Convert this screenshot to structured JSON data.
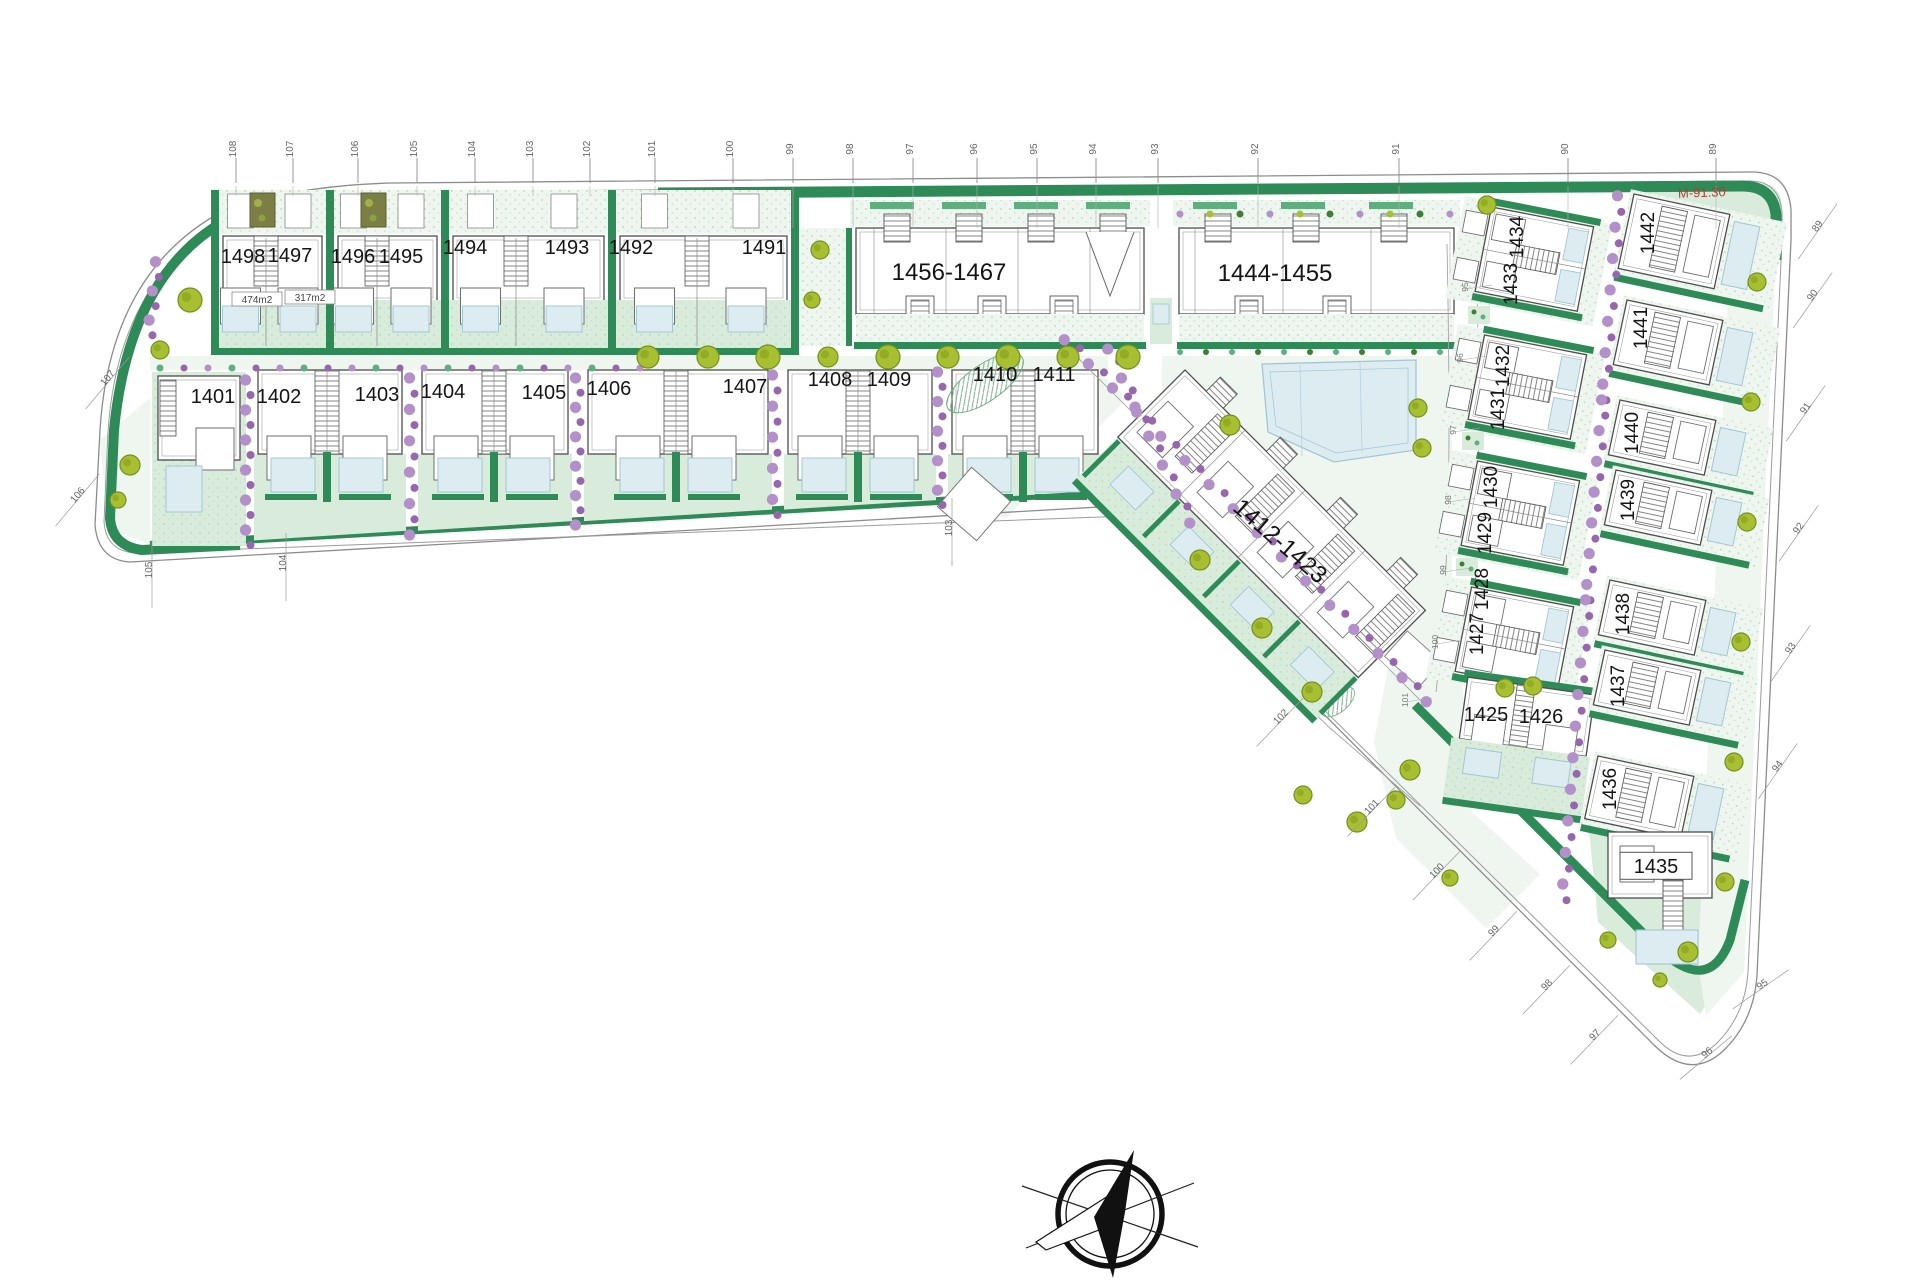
{
  "plan": {
    "background": "#ffffff",
    "colors": {
      "boundary_line": "#8c8c8c",
      "inner_line": "#9c9c9c",
      "hedge_dark": "#2e8a57",
      "hedge_mid": "#5fae7f",
      "lawn_light": "#eef6ef",
      "lawn_mid": "#d9ecdc",
      "pool_fill": "#dcecf1",
      "pool_line": "#a3c6d4",
      "tree_fill": "#a7bf31",
      "tree_line": "#75911f",
      "shrub_purple": "#b490cb",
      "shrub_purple_dark": "#9766ae",
      "building_line": "#4d4d4d",
      "room_line": "#6e6e6e",
      "label_color": "#141414",
      "tick_color": "#666666",
      "red_annotation": "#b33f31",
      "pergola_fill": "#7b7f45",
      "road_line": "#a5a5a5"
    },
    "plots": {
      "row_top": [
        {
          "t": "1498",
          "x": 243,
          "y": 263
        },
        {
          "t": "1497",
          "x": 290,
          "y": 262
        },
        {
          "t": "1496",
          "x": 353,
          "y": 263
        },
        {
          "t": "1495",
          "x": 401,
          "y": 263
        },
        {
          "t": "1494",
          "x": 465,
          "y": 254
        },
        {
          "t": "1493",
          "x": 567,
          "y": 254
        },
        {
          "t": "1492",
          "x": 631,
          "y": 254
        },
        {
          "t": "1491",
          "x": 764,
          "y": 254
        }
      ],
      "row_middle": [
        {
          "t": "1401",
          "x": 213,
          "y": 403
        },
        {
          "t": "1402",
          "x": 279,
          "y": 403
        },
        {
          "t": "1403",
          "x": 377,
          "y": 401
        },
        {
          "t": "1404",
          "x": 443,
          "y": 398
        },
        {
          "t": "1405",
          "x": 544,
          "y": 399
        },
        {
          "t": "1406",
          "x": 609,
          "y": 395
        },
        {
          "t": "1407",
          "x": 745,
          "y": 393
        },
        {
          "t": "1408",
          "x": 830,
          "y": 386
        },
        {
          "t": "1409",
          "x": 889,
          "y": 386
        },
        {
          "t": "1410",
          "x": 995,
          "y": 381
        },
        {
          "t": "1411",
          "x": 1054,
          "y": 381
        }
      ],
      "column_inner": [
        {
          "t": "1434",
          "x": 1523,
          "y": 237,
          "rot": -90
        },
        {
          "t": "1433",
          "x": 1517,
          "y": 284,
          "rot": -90
        },
        {
          "t": "1432",
          "x": 1509,
          "y": 366,
          "rot": -90
        },
        {
          "t": "1431",
          "x": 1504,
          "y": 409,
          "rot": -90
        },
        {
          "t": "1430",
          "x": 1497,
          "y": 487,
          "rot": -90
        },
        {
          "t": "1429",
          "x": 1491,
          "y": 533,
          "rot": -90
        },
        {
          "t": "1428",
          "x": 1488,
          "y": 589,
          "rot": -90
        },
        {
          "t": "1427",
          "x": 1483,
          "y": 634,
          "rot": -90
        }
      ],
      "pair_bottom": [
        {
          "t": "1425",
          "x": 1486,
          "y": 721
        },
        {
          "t": "1426",
          "x": 1541,
          "y": 723
        }
      ],
      "column_outer": [
        {
          "t": "1442",
          "x": 1654,
          "y": 233,
          "rot": -90
        },
        {
          "t": "1441",
          "x": 1647,
          "y": 328,
          "rot": -90
        },
        {
          "t": "1440",
          "x": 1638,
          "y": 433,
          "rot": -90
        },
        {
          "t": "1439",
          "x": 1634,
          "y": 500,
          "rot": -90
        },
        {
          "t": "1438",
          "x": 1629,
          "y": 614,
          "rot": -90
        },
        {
          "t": "1437",
          "x": 1624,
          "y": 686,
          "rot": -90
        },
        {
          "t": "1436",
          "x": 1616,
          "y": 789,
          "rot": -90
        }
      ],
      "corner": [
        {
          "t": "1435",
          "x": 1656,
          "y": 873,
          "box": [
            72,
            27
          ]
        }
      ],
      "blocks": [
        {
          "t": "1456-1467",
          "x": 949,
          "y": 280,
          "size": 24
        },
        {
          "t": "1444-1455",
          "x": 1275,
          "y": 281,
          "size": 24
        },
        {
          "t": "1412-1423",
          "x": 1275,
          "y": 547,
          "size": 24,
          "rot": 41
        }
      ]
    },
    "area_labels": [
      {
        "t": "474m2",
        "x": 257,
        "y": 303,
        "box": [
          50,
          14
        ]
      },
      {
        "t": "317m2",
        "x": 310,
        "y": 301,
        "box": [
          50,
          14
        ]
      }
    ],
    "annotation": {
      "t": "M-91.30",
      "x": 1702,
      "y": 197,
      "rot": -2
    },
    "ticks": {
      "top": [
        {
          "t": "108",
          "x": 236
        },
        {
          "t": "107",
          "x": 293
        },
        {
          "t": "106",
          "x": 358
        },
        {
          "t": "105",
          "x": 417
        },
        {
          "t": "104",
          "x": 475
        },
        {
          "t": "103",
          "x": 533
        },
        {
          "t": "102",
          "x": 590
        },
        {
          "t": "101",
          "x": 655
        },
        {
          "t": "100",
          "x": 733
        },
        {
          "t": "99",
          "x": 793
        },
        {
          "t": "98",
          "x": 853
        },
        {
          "t": "97",
          "x": 913
        },
        {
          "t": "96",
          "x": 977
        },
        {
          "t": "95",
          "x": 1037
        },
        {
          "t": "94",
          "x": 1096
        },
        {
          "t": "93",
          "x": 1158
        },
        {
          "t": "92",
          "x": 1258
        },
        {
          "t": "91",
          "x": 1399
        },
        {
          "t": "90",
          "x": 1568
        },
        {
          "t": "89",
          "x": 1716
        }
      ],
      "perimeter": [
        {
          "t": "107",
          "x": 110,
          "y": 380,
          "rot": -50
        },
        {
          "t": "106",
          "x": 80,
          "y": 497,
          "rot": -50
        },
        {
          "t": "105",
          "x": 152,
          "y": 570,
          "rot": -90
        },
        {
          "t": "104",
          "x": 286,
          "y": 563,
          "rot": -90
        },
        {
          "t": "103",
          "x": 952,
          "y": 528,
          "rot": -90
        },
        {
          "t": "102",
          "x": 1283,
          "y": 719,
          "rot": -46
        },
        {
          "t": "101",
          "x": 1374,
          "y": 809,
          "rot": -46
        },
        {
          "t": "100",
          "x": 1439,
          "y": 873,
          "rot": -46
        },
        {
          "t": "99",
          "x": 1496,
          "y": 933,
          "rot": -46
        },
        {
          "t": "98",
          "x": 1549,
          "y": 987,
          "rot": -46
        },
        {
          "t": "97",
          "x": 1597,
          "y": 1037,
          "rot": -46
        },
        {
          "t": "96",
          "x": 1709,
          "y": 1055,
          "rot": -40
        },
        {
          "t": "95",
          "x": 1764,
          "y": 987,
          "rot": -35
        },
        {
          "t": "94",
          "x": 1780,
          "y": 768,
          "rot": -55
        },
        {
          "t": "93",
          "x": 1793,
          "y": 650,
          "rot": -55
        },
        {
          "t": "92",
          "x": 1801,
          "y": 530,
          "rot": -55
        },
        {
          "t": "91",
          "x": 1808,
          "y": 410,
          "rot": -55
        },
        {
          "t": "90",
          "x": 1815,
          "y": 297,
          "rot": -55
        },
        {
          "t": "89",
          "x": 1820,
          "y": 228,
          "rot": -55
        }
      ],
      "internal": [
        {
          "t": "95",
          "x": 1468,
          "y": 287
        },
        {
          "t": "96",
          "x": 1463,
          "y": 358
        },
        {
          "t": "97",
          "x": 1456,
          "y": 430
        },
        {
          "t": "98",
          "x": 1451,
          "y": 500
        },
        {
          "t": "99",
          "x": 1446,
          "y": 570
        },
        {
          "t": "100",
          "x": 1438,
          "y": 642
        },
        {
          "t": "101",
          "x": 1408,
          "y": 700
        }
      ]
    },
    "compass": {
      "cx": 1110,
      "cy": 1214,
      "r_outer": 52,
      "r_inner": 44
    }
  }
}
